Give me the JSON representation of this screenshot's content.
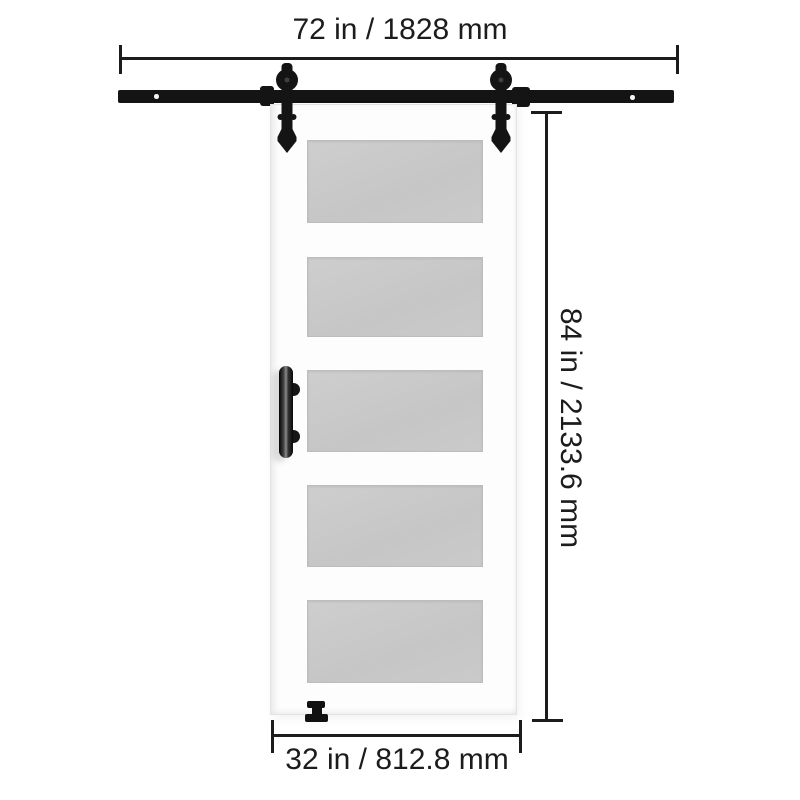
{
  "dimension_labels": {
    "rail_width": "72 in / 1828 mm",
    "door_height": "84 in / 2133.6 mm",
    "door_width": "32 in / 812.8 mm"
  },
  "door": {
    "glass_panel_count": 5,
    "style": "5-lite frosted glass sliding barn door"
  },
  "colors": {
    "background": "#ffffff",
    "hardware-black": "#141414",
    "dimension-ink": "#1c1c1c",
    "door-face": "#fdfdfd",
    "door-edge": "#e3e3e3",
    "glass-gray": "#c8c8c8",
    "handle-highlight": "#8a8a8a"
  }
}
